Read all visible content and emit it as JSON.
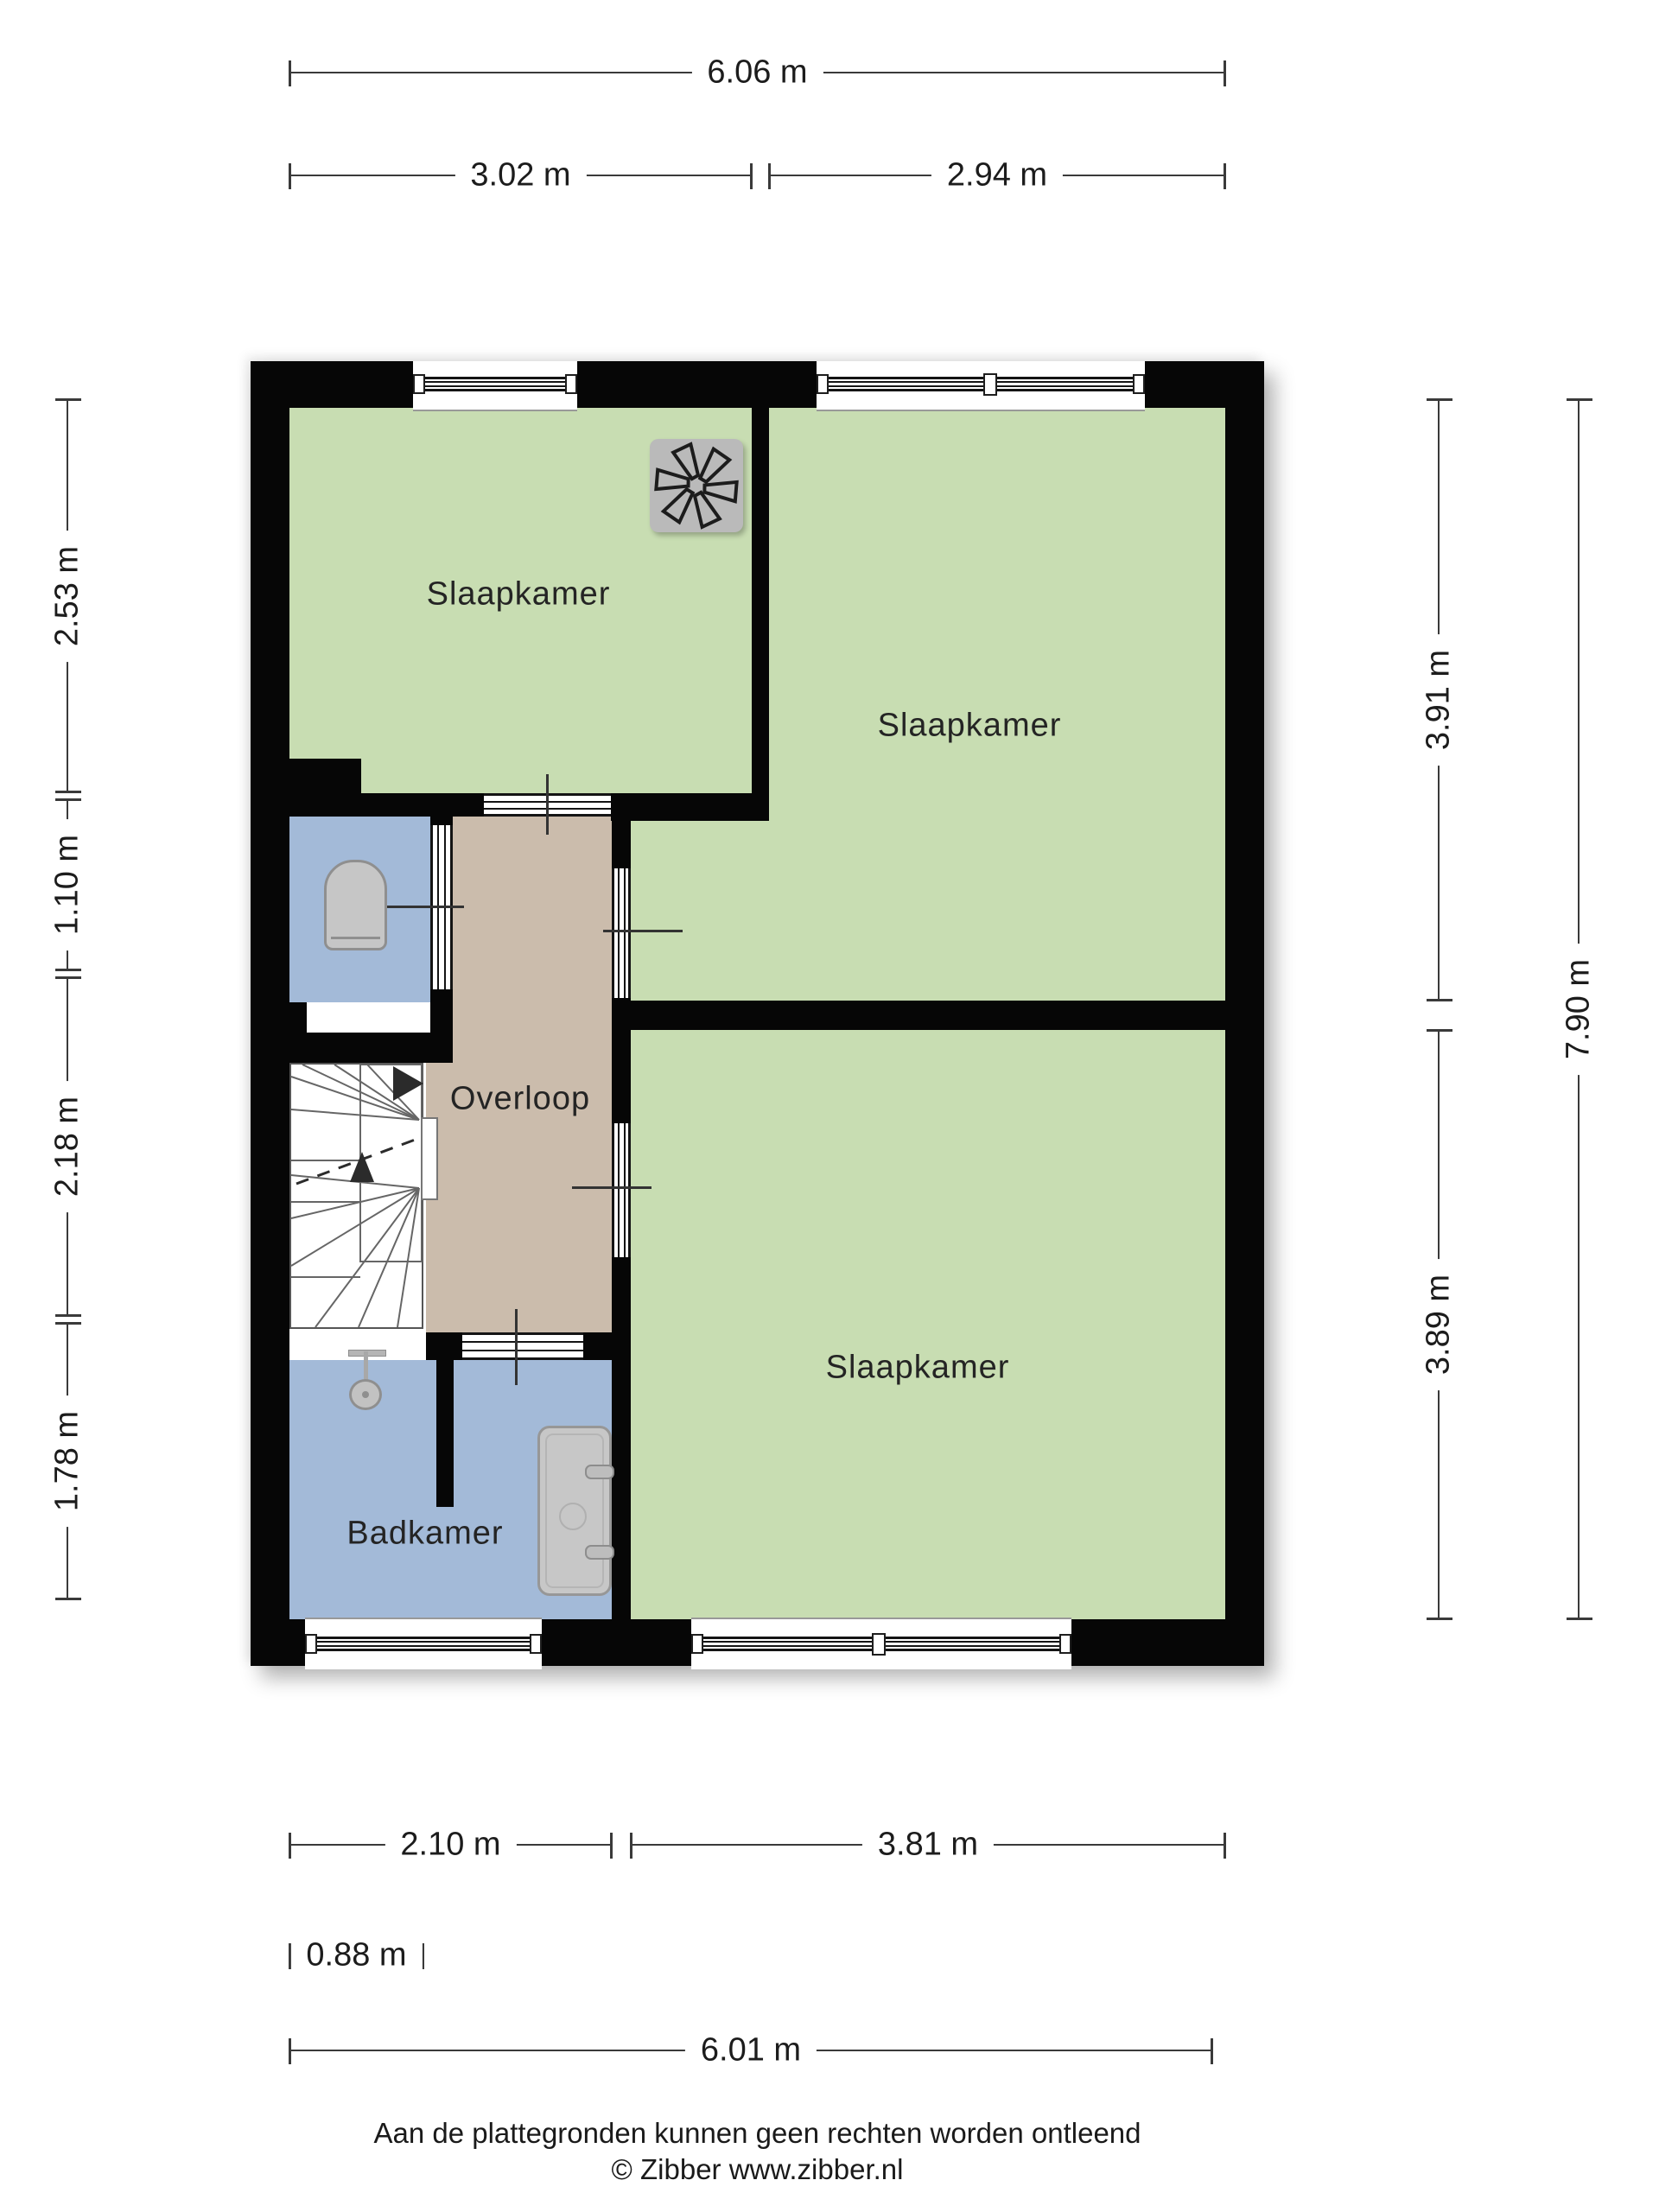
{
  "floorplan": {
    "rooms": {
      "bedroom_top_left": {
        "label": "Slaapkamer"
      },
      "bedroom_top_right": {
        "label": "Slaapkamer"
      },
      "bedroom_bottom_right": {
        "label": "Slaapkamer"
      },
      "landing": {
        "label": "Overloop"
      },
      "bathroom": {
        "label": "Badkamer"
      }
    },
    "colors": {
      "bedroom": "#c8ddb2",
      "bathroom": "#a3bad8",
      "landing": "#cbbcac",
      "wall": "#060606",
      "fixture": "#c6c6c6"
    },
    "icons": {
      "fan": "ventilation-fan-icon",
      "toilet": "toilet-icon",
      "shower": "shower-icon",
      "basin": "washbasin-icon",
      "stairs": "stairs-icon"
    }
  },
  "dimensions": {
    "top_total": "6.06 m",
    "top_left": "3.02 m",
    "top_right": "2.94 m",
    "left_upper": "2.53 m",
    "left_toilet": "1.10 m",
    "left_stairs": "2.18 m",
    "left_bathroom": "1.78 m",
    "right_upper": "3.91 m",
    "right_lower": "3.89 m",
    "right_total": "7.90 m",
    "bottom_bathroom": "2.10 m",
    "bottom_bedroom": "3.81 m",
    "stairs_width": "0.88 m",
    "bottom_total": "6.01 m"
  },
  "footer": {
    "disclaimer": "Aan de plattegronden kunnen geen rechten worden ontleend",
    "copyright": "© Zibber www.zibber.nl"
  }
}
